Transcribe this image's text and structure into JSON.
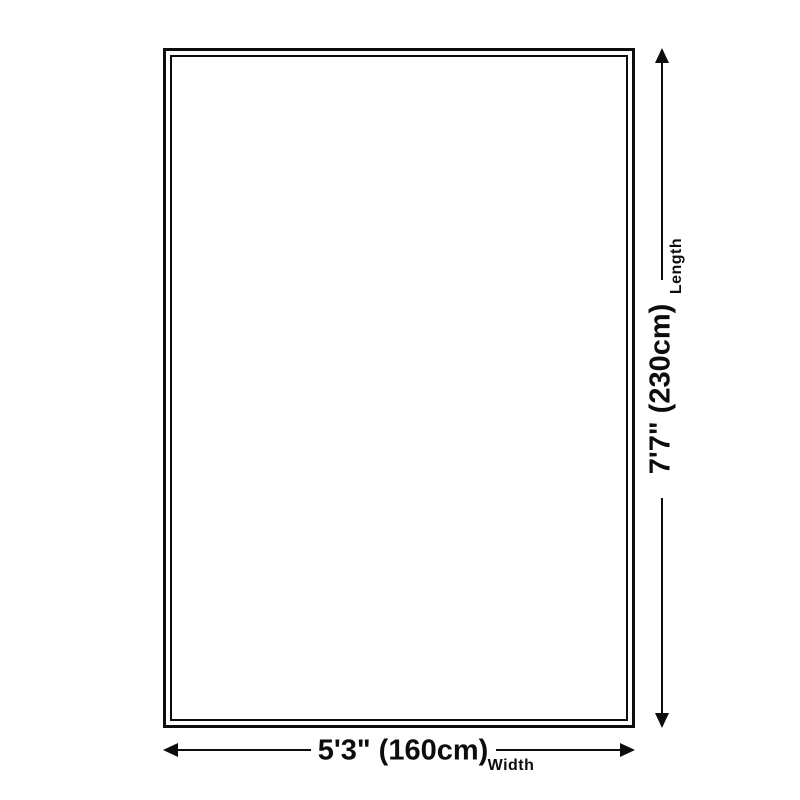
{
  "diagram": {
    "type": "product-dimension-diagram",
    "subject": "rug",
    "length": {
      "value": "7'7\" (230cm)",
      "label": "Length",
      "orientation": "vertical"
    },
    "width": {
      "value": "5'3\" (160cm)",
      "label": "Width",
      "orientation": "horizontal"
    },
    "colors": {
      "line": "#0d0d0d",
      "text": "#0d0d0d",
      "background": "#ffffff"
    }
  }
}
